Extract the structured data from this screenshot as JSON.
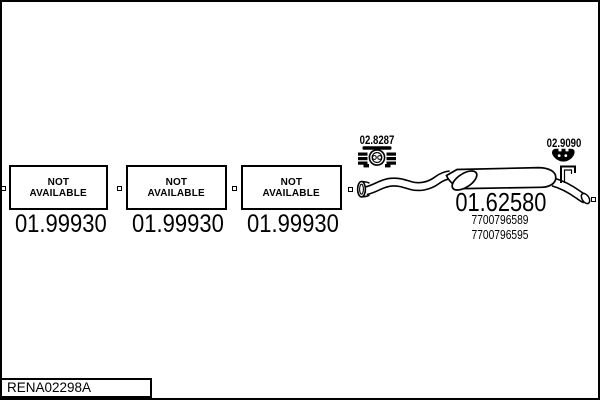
{
  "page": {
    "ink_color": "#000000",
    "paper_color": "#ffffff",
    "footer_code": "RENA02298A"
  },
  "boxes": [
    {
      "line1": "NOT",
      "line2": "AVAILABLE",
      "part": "01.99930"
    },
    {
      "line1": "NOT",
      "line2": "AVAILABLE",
      "part": "01.99930"
    },
    {
      "line1": "NOT",
      "line2": "AVAILABLE",
      "part": "01.99930"
    }
  ],
  "muffler": {
    "part": "01.62580",
    "oem1": "7700796589",
    "oem2": "7700796595"
  },
  "clamps": [
    {
      "part": "02.8287",
      "icon": "band-clamp-icon"
    },
    {
      "part": "02.9090",
      "icon": "rubber-hanger-icon"
    }
  ]
}
